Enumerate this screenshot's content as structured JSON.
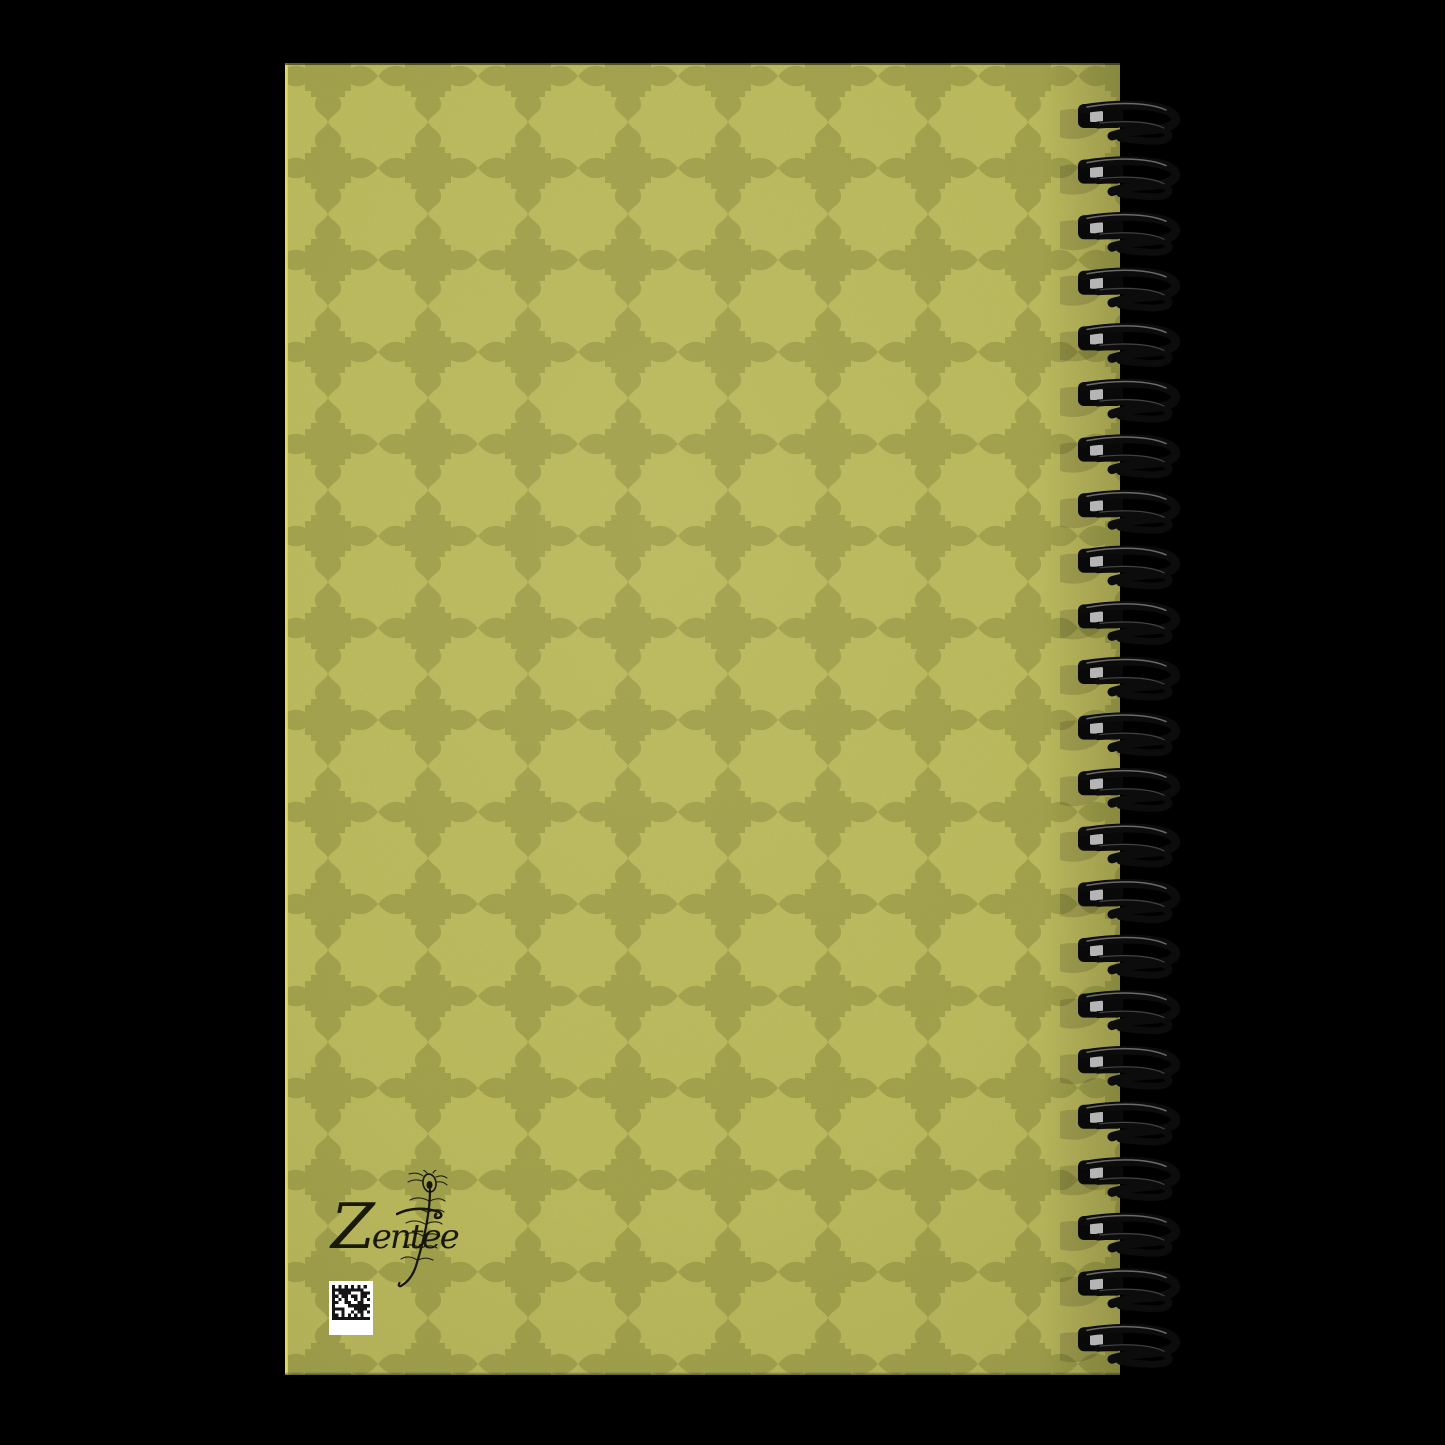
{
  "scene": {
    "background_color": "#000000"
  },
  "notebook": {
    "brand_logo_text": "Zentee",
    "cover_pattern": {
      "motif": "moroccan-star-and-cross",
      "light": "#c3c161",
      "dark": "#a8a850",
      "edge_highlight": "#e8e062"
    },
    "binding": {
      "loop_count": 23,
      "wire_color": "#0c0c0c",
      "hole_color": "#090909",
      "hole_highlight": "#cdcdcd"
    },
    "qr_label": {
      "background": "#ffffff",
      "module_color": "#151515"
    }
  }
}
